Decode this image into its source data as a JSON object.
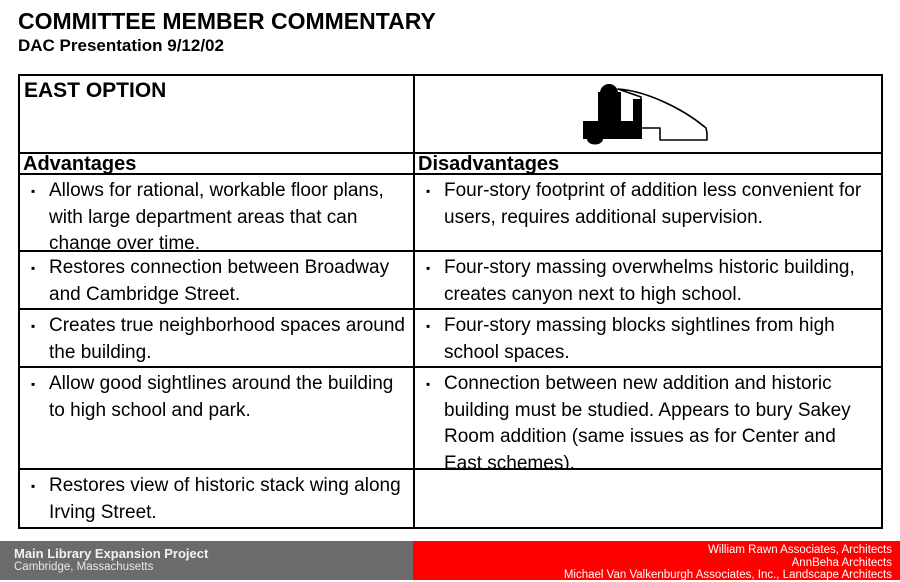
{
  "slide": {
    "title": "COMMITTEE MEMBER COMMENTARY",
    "subtitle": "DAC Presentation 9/12/02"
  },
  "icons": {
    "bullet_glyph": "▪",
    "plan_icon": "east-option-site-plan-icon"
  },
  "table": {
    "option_title": "EAST OPTION",
    "columns": {
      "advantages_label": "Advantages",
      "disadvantages_label": "Disadvantages"
    },
    "rows": [
      {
        "advantage": "Allows for rational, workable floor plans, with large department areas that can change over time.",
        "disadvantage": "Four-story footprint of addition less convenient for users, requires additional supervision."
      },
      {
        "advantage": "Restores connection between Broadway and Cambridge Street.",
        "disadvantage": "Four-story massing overwhelms historic building, creates canyon next to high school."
      },
      {
        "advantage": "Creates true neighborhood spaces around the building.",
        "disadvantage": "Four-story massing blocks sightlines from high school spaces."
      },
      {
        "advantage": "Allow good sightlines around the building to high school and park.",
        "disadvantage": "Connection between new addition and historic building must be studied.  Appears to bury Sakey Room addition (same issues as for Center and East schemes)."
      },
      {
        "advantage": "Restores view of historic stack wing along Irving Street.",
        "disadvantage": ""
      }
    ]
  },
  "footer": {
    "left": {
      "project": "Main Library Expansion Project",
      "location": "Cambridge, Massachusetts",
      "background": "#6b6b6b"
    },
    "right": {
      "credits": [
        "William Rawn Associates, Architects",
        "AnnBeha Architects",
        "Michael Van Valkenburgh Associates, Inc., Landscape Architects"
      ],
      "background": "#fe0000"
    }
  }
}
